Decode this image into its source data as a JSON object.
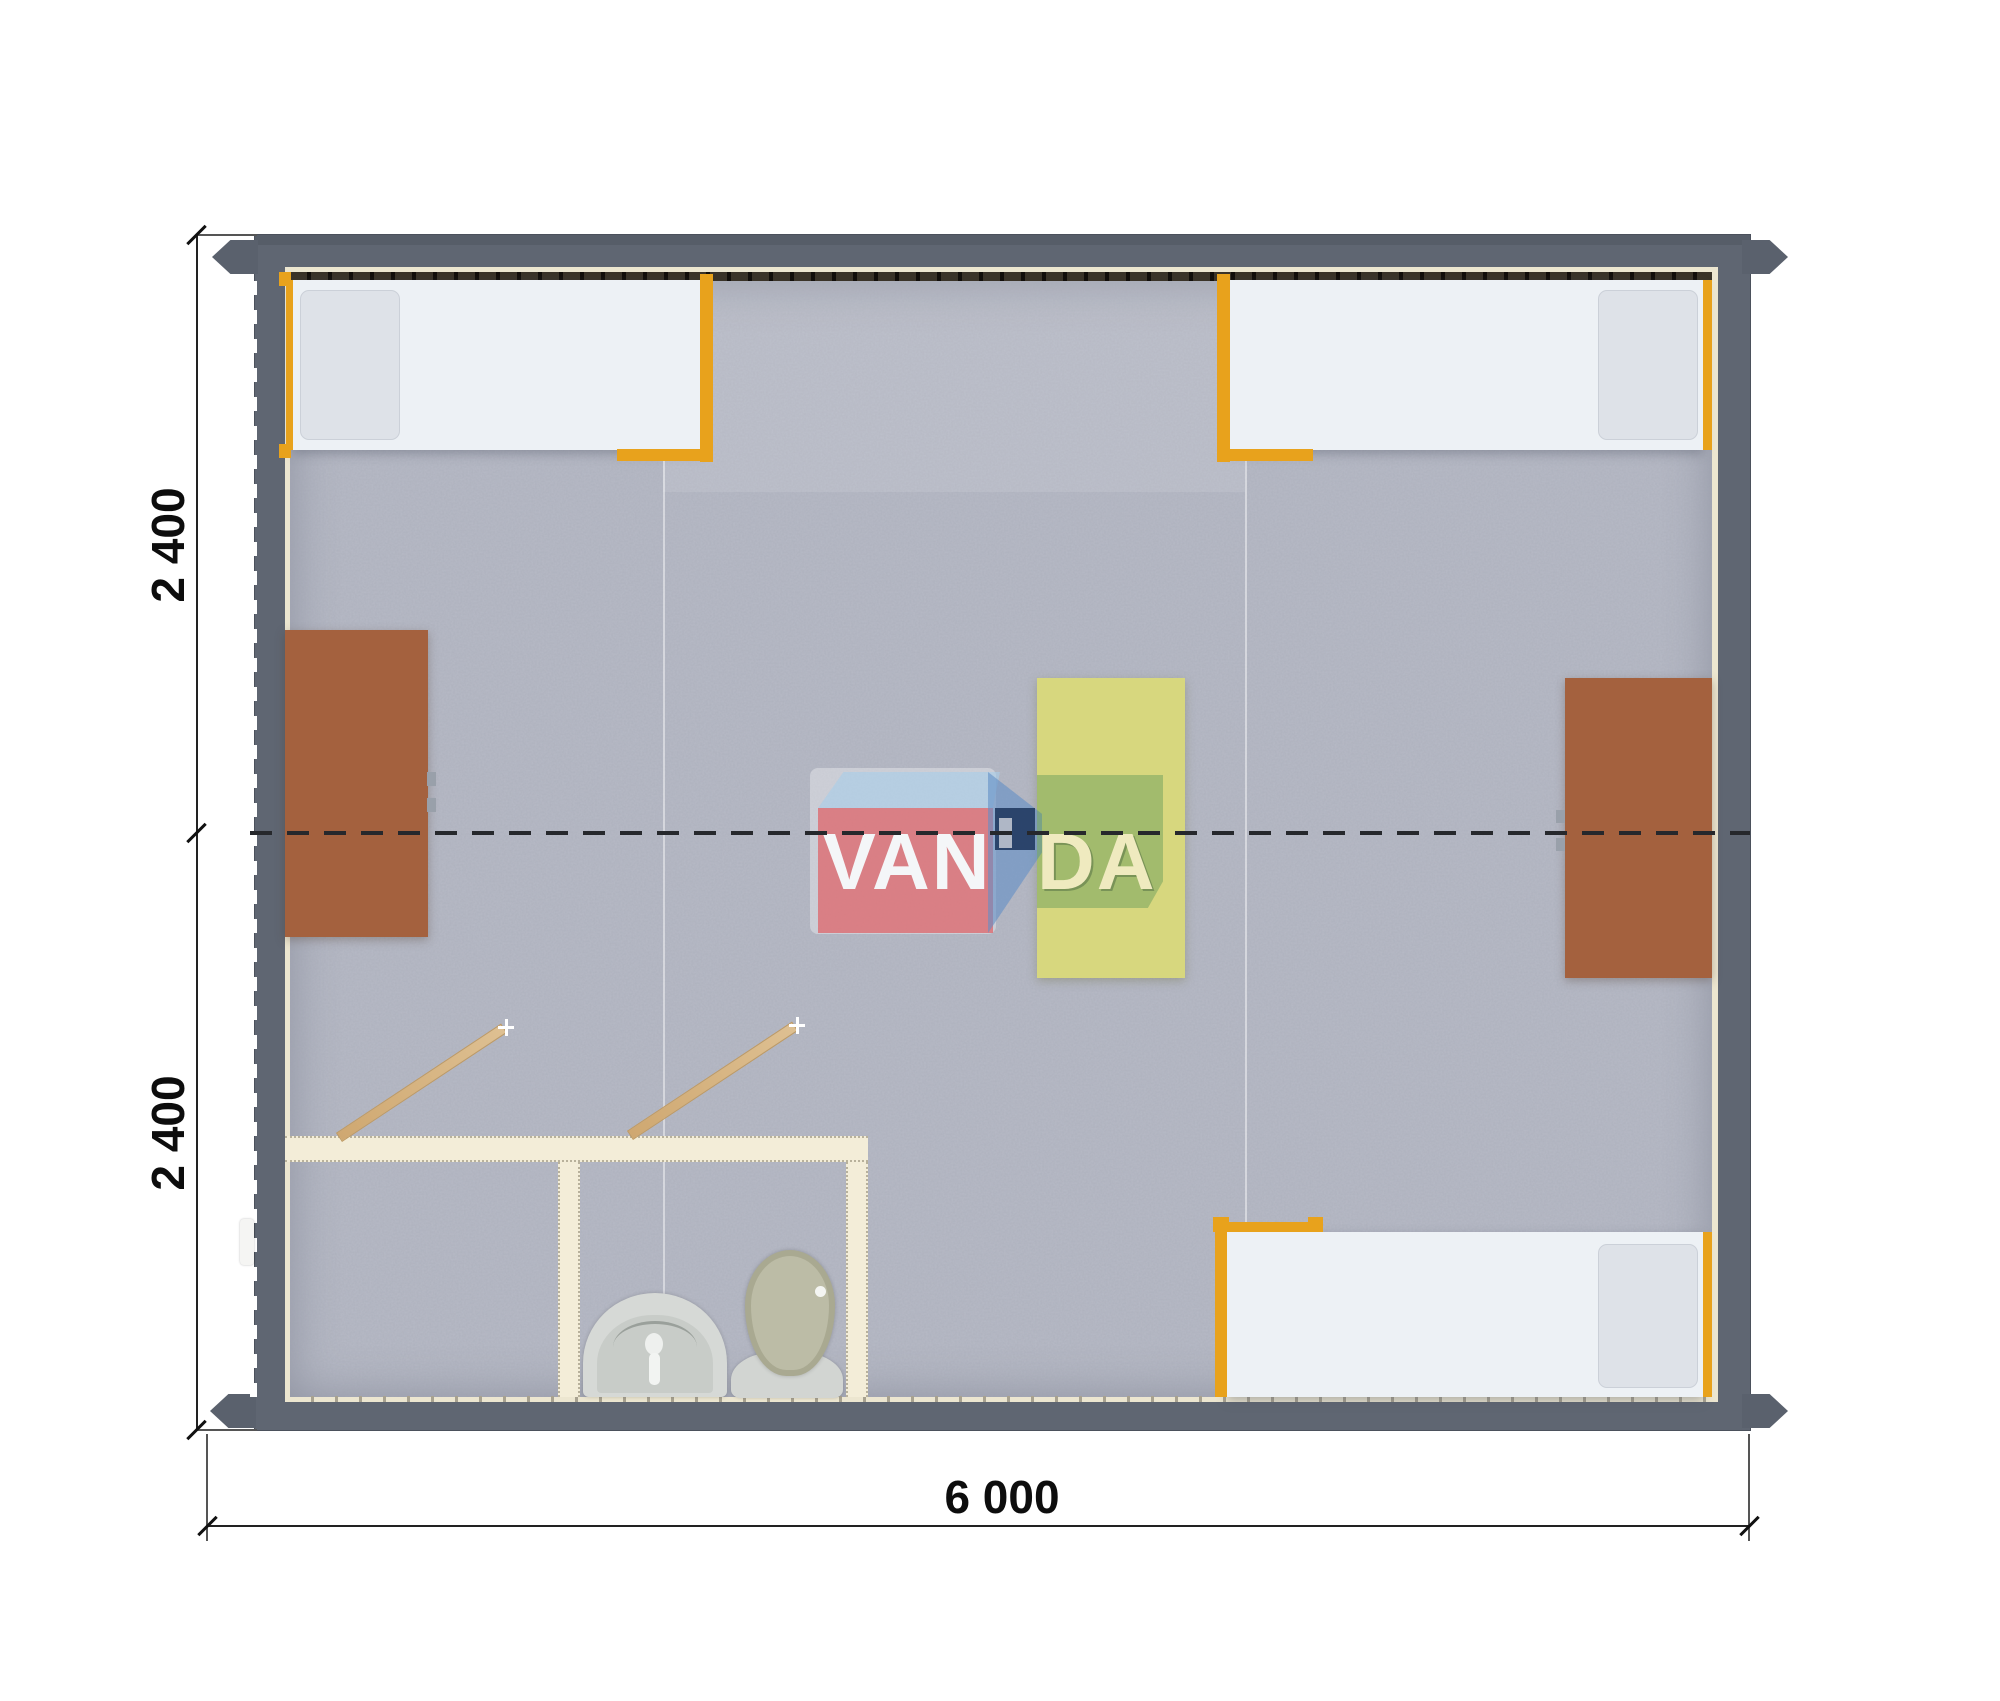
{
  "drawing": {
    "type": "floor-plan-top-view",
    "building_modules": 2,
    "colors": {
      "wall": "#5f6672",
      "floor_carpet": "#b7bac6",
      "interior_lining": "#ece6d0",
      "bed_frame_orange": "#e8a21c",
      "desk_brown": "#a4613e",
      "table_yellow": "#d7d77e",
      "bathroom_wall": "#f3edd8",
      "door_wood": "#d8b88a",
      "dimension_ink": "#111111",
      "logo_red": "#de646a",
      "logo_blue": "#628ec6",
      "logo_navy": "#203860",
      "logo_green": "#5c9658"
    },
    "furniture": [
      {
        "name": "single-bed",
        "count": 3
      },
      {
        "name": "desk-brown",
        "count": 2
      },
      {
        "name": "table-yellow",
        "count": 1
      },
      {
        "name": "washbasin",
        "count": 1
      },
      {
        "name": "toilet",
        "count": 1
      },
      {
        "name": "door-leaf",
        "count": 2
      }
    ]
  },
  "dimensions": {
    "vertical": [
      {
        "label": "2 400"
      },
      {
        "label": "2 400"
      }
    ],
    "horizontal": {
      "label": "6 000"
    }
  },
  "watermark": {
    "text_left": "VAN",
    "text_right": "DA"
  }
}
